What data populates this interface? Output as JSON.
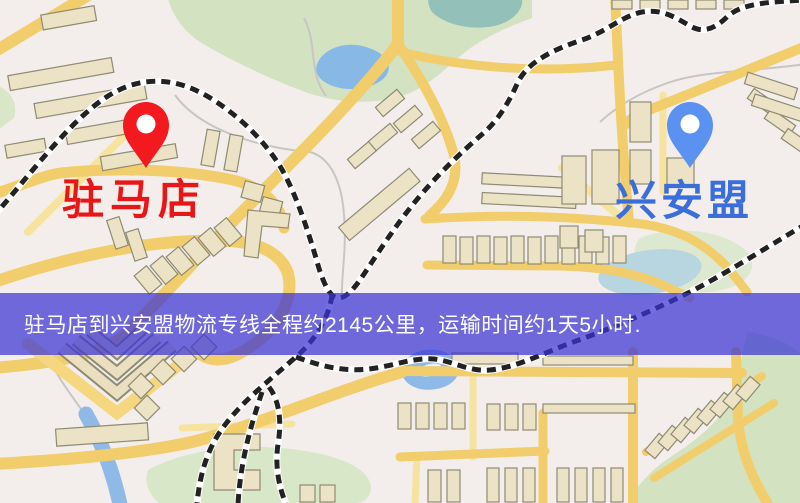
{
  "markers": {
    "origin": {
      "label": "驻马店",
      "pin_color": "#f2191f",
      "label_color": "#e81616",
      "icon": "map-pin-icon"
    },
    "destination": {
      "label": "兴安盟",
      "pin_color": "#5b92f2",
      "label_color": "#3a6edb",
      "icon": "map-pin-icon"
    }
  },
  "banner": {
    "text": "驻马店到兴安盟物流专线全程约2145公里，运输时间约1天5小时.",
    "background": "rgba(58,52,212,0.72)",
    "text_color": "#ffffff"
  },
  "map_palette": {
    "background": "#f3eeeb",
    "road_major": "#f1cd6c",
    "road_minor": "#f7e3a0",
    "park": "#d3e2c0",
    "water": "#87b8e6",
    "pond": "#93c0b8",
    "railway": "#222222",
    "building": "#ece3c7",
    "building_outline": "#8f8a72"
  }
}
